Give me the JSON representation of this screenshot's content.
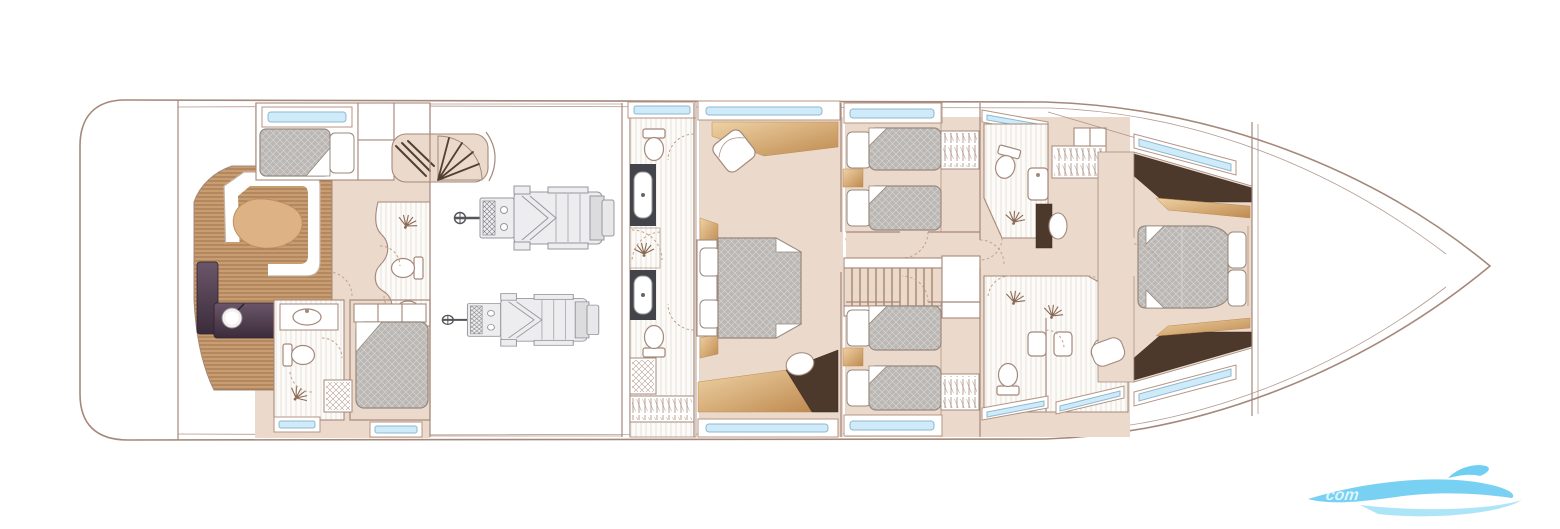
{
  "palette": {
    "outline": "#a5887a",
    "floor": "#ebdacc",
    "bath_floor": "#fcfbf9",
    "bath_line": "#e7e1d8",
    "teak": "#c89d72",
    "teak_line": "#a1734a",
    "table": "#ddb285",
    "table_line": "#bf8f5e",
    "purple_1": "#6b5669",
    "purple_2": "#3b2c3b",
    "mattress": "#bab7b4",
    "mattress_line": "#d6d4d2",
    "bed_stroke": "#97897d",
    "tan_1": "#eed2a4",
    "tan_2": "#bf8a50",
    "brown": "#4d392b",
    "window_blue": "#cfeaf8",
    "window_stroke": "#8fb9cd",
    "frame": "#b49584",
    "engine": "#97979c",
    "engine_dark": "#55555c",
    "engine_fill": "#ededef",
    "counter_dark": "#43434a",
    "stair": "#52402f",
    "fixture": "#a5887a",
    "dash": "#c2a089",
    "spray": "#8a6a55",
    "watermark_1": "#56c6ef",
    "watermark_2": "#9fe0f7"
  },
  "watermark": {
    "text": "com"
  }
}
